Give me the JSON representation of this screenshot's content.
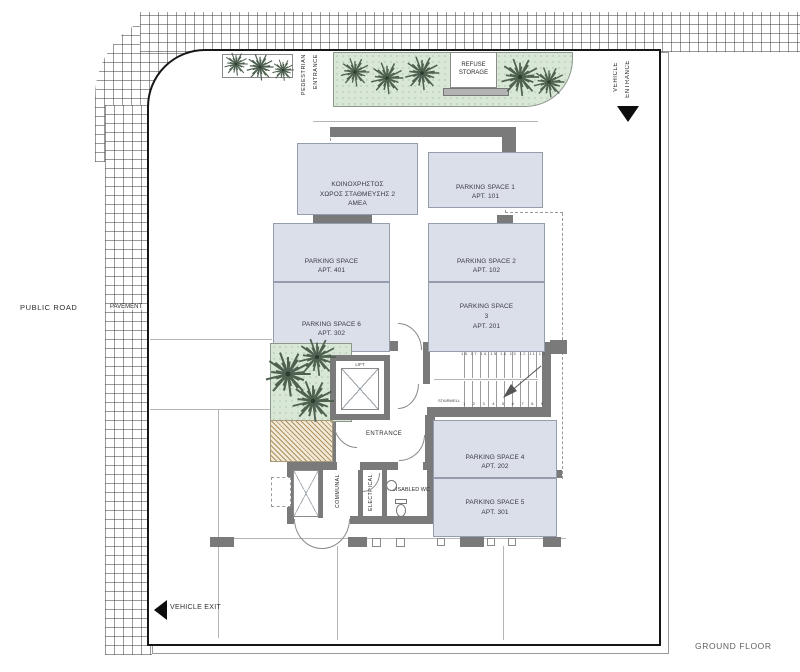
{
  "plan": {
    "floor_label": "GROUND FLOOR",
    "public_road": "PUBLIC ROAD",
    "pavement": "PAVEMENT",
    "pedestrian_entrance": [
      "PEDESTRIAN",
      "ENTRANCE"
    ],
    "vehicle_entrance": [
      "VEHICLE",
      "ENTRANCE"
    ],
    "vehicle_exit": "VEHICLE EXIT",
    "refuse_storage": [
      "REFUSE",
      "STORAGE"
    ]
  },
  "core": {
    "lift": "LIFT",
    "stairwell": "STAIRWELL",
    "entrance": "ENTRANCE",
    "communal": "COMMUNAL",
    "electrical": "ELECTRICAL",
    "disabled_wc": "DISABLED WC",
    "stair_numbers_top": "18 17 16 15 14 13 12 11 10",
    "stair_numbers_bottom": "1 2 3 4 5 6 7 8 9"
  },
  "spaces": [
    {
      "name": "communal-disabled-parking",
      "lines": [
        "ΚΟΙΝΟΧΡΗΣΤΟΣ",
        "ΧΩΡΟΣ ΣΤΑΘΜΕΥΣΗΣ 2",
        "ΑΜΕΑ"
      ]
    },
    {
      "name": "parking-space-1",
      "lines": [
        "PARKING SPACE 1",
        "APT. 101"
      ]
    },
    {
      "name": "parking-space-401",
      "lines": [
        "PARKING SPACE",
        "APT. 401"
      ]
    },
    {
      "name": "parking-space-2",
      "lines": [
        "PARKING SPACE 2",
        "APT. 102"
      ]
    },
    {
      "name": "parking-space-6",
      "lines": [
        "PARKING SPACE 6",
        "APT. 302"
      ]
    },
    {
      "name": "parking-space-3",
      "lines": [
        "PARKING SPACE",
        "3",
        "APT. 201"
      ]
    },
    {
      "name": "parking-space-4",
      "lines": [
        "PARKING SPACE 4",
        "APT. 202"
      ]
    },
    {
      "name": "parking-space-5",
      "lines": [
        "PARKING SPACE 5",
        "APT. 301"
      ]
    }
  ],
  "colors": {
    "parking_fill": "#dbdfe9",
    "wall_gray": "#7a7a7a",
    "planting_green": "#d9e7d6",
    "ramp_hatch_tan": "#c8b083",
    "boundary_black": "#161616"
  }
}
